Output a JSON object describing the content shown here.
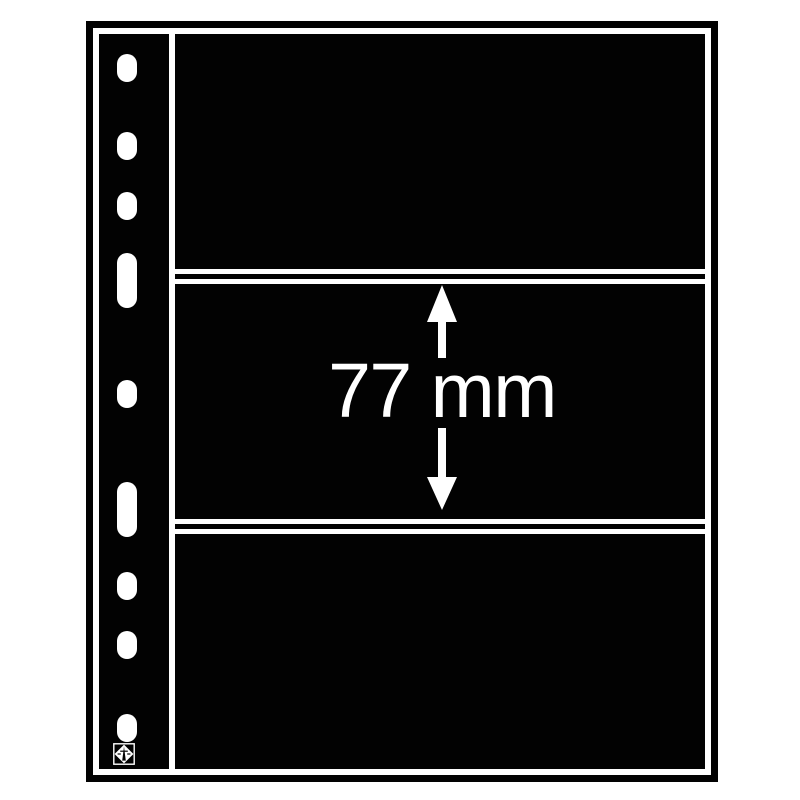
{
  "measurement": {
    "label": "77 mm"
  },
  "colors": {
    "sheet": "#020202",
    "lines": "#ffffff",
    "background": "#ffffff"
  },
  "structure": {
    "pocket_count": 3,
    "punch_hole_count": 9,
    "divider_line_count": 4
  }
}
